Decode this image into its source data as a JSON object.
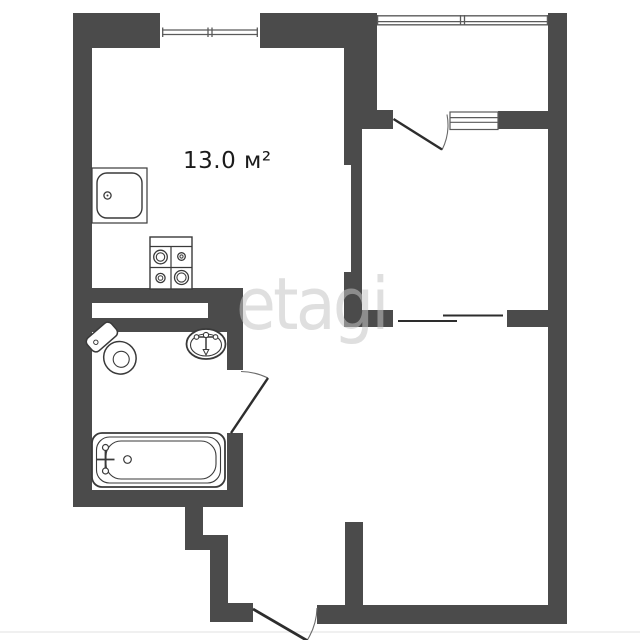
{
  "floorplan": {
    "area_label": "13.0 м²",
    "watermark": "etagi",
    "colors": {
      "wall": "#4b4b4b",
      "fixture_stroke": "#3a3a3a",
      "door_stroke": "#2d2d2d",
      "window_stroke": "#5a5a5a",
      "label_text": "#1b1b1b",
      "watermark_tint": "rgba(197,197,197,0.55)",
      "background": "#ffffff"
    },
    "fixtures": [
      "kitchen-sink-icon",
      "stove-icon",
      "toilet-icon",
      "washbasin-icon",
      "bathtub-icon"
    ],
    "openings": {
      "windows": 3,
      "swing_doors": 3,
      "sliding_doors": 1
    }
  }
}
